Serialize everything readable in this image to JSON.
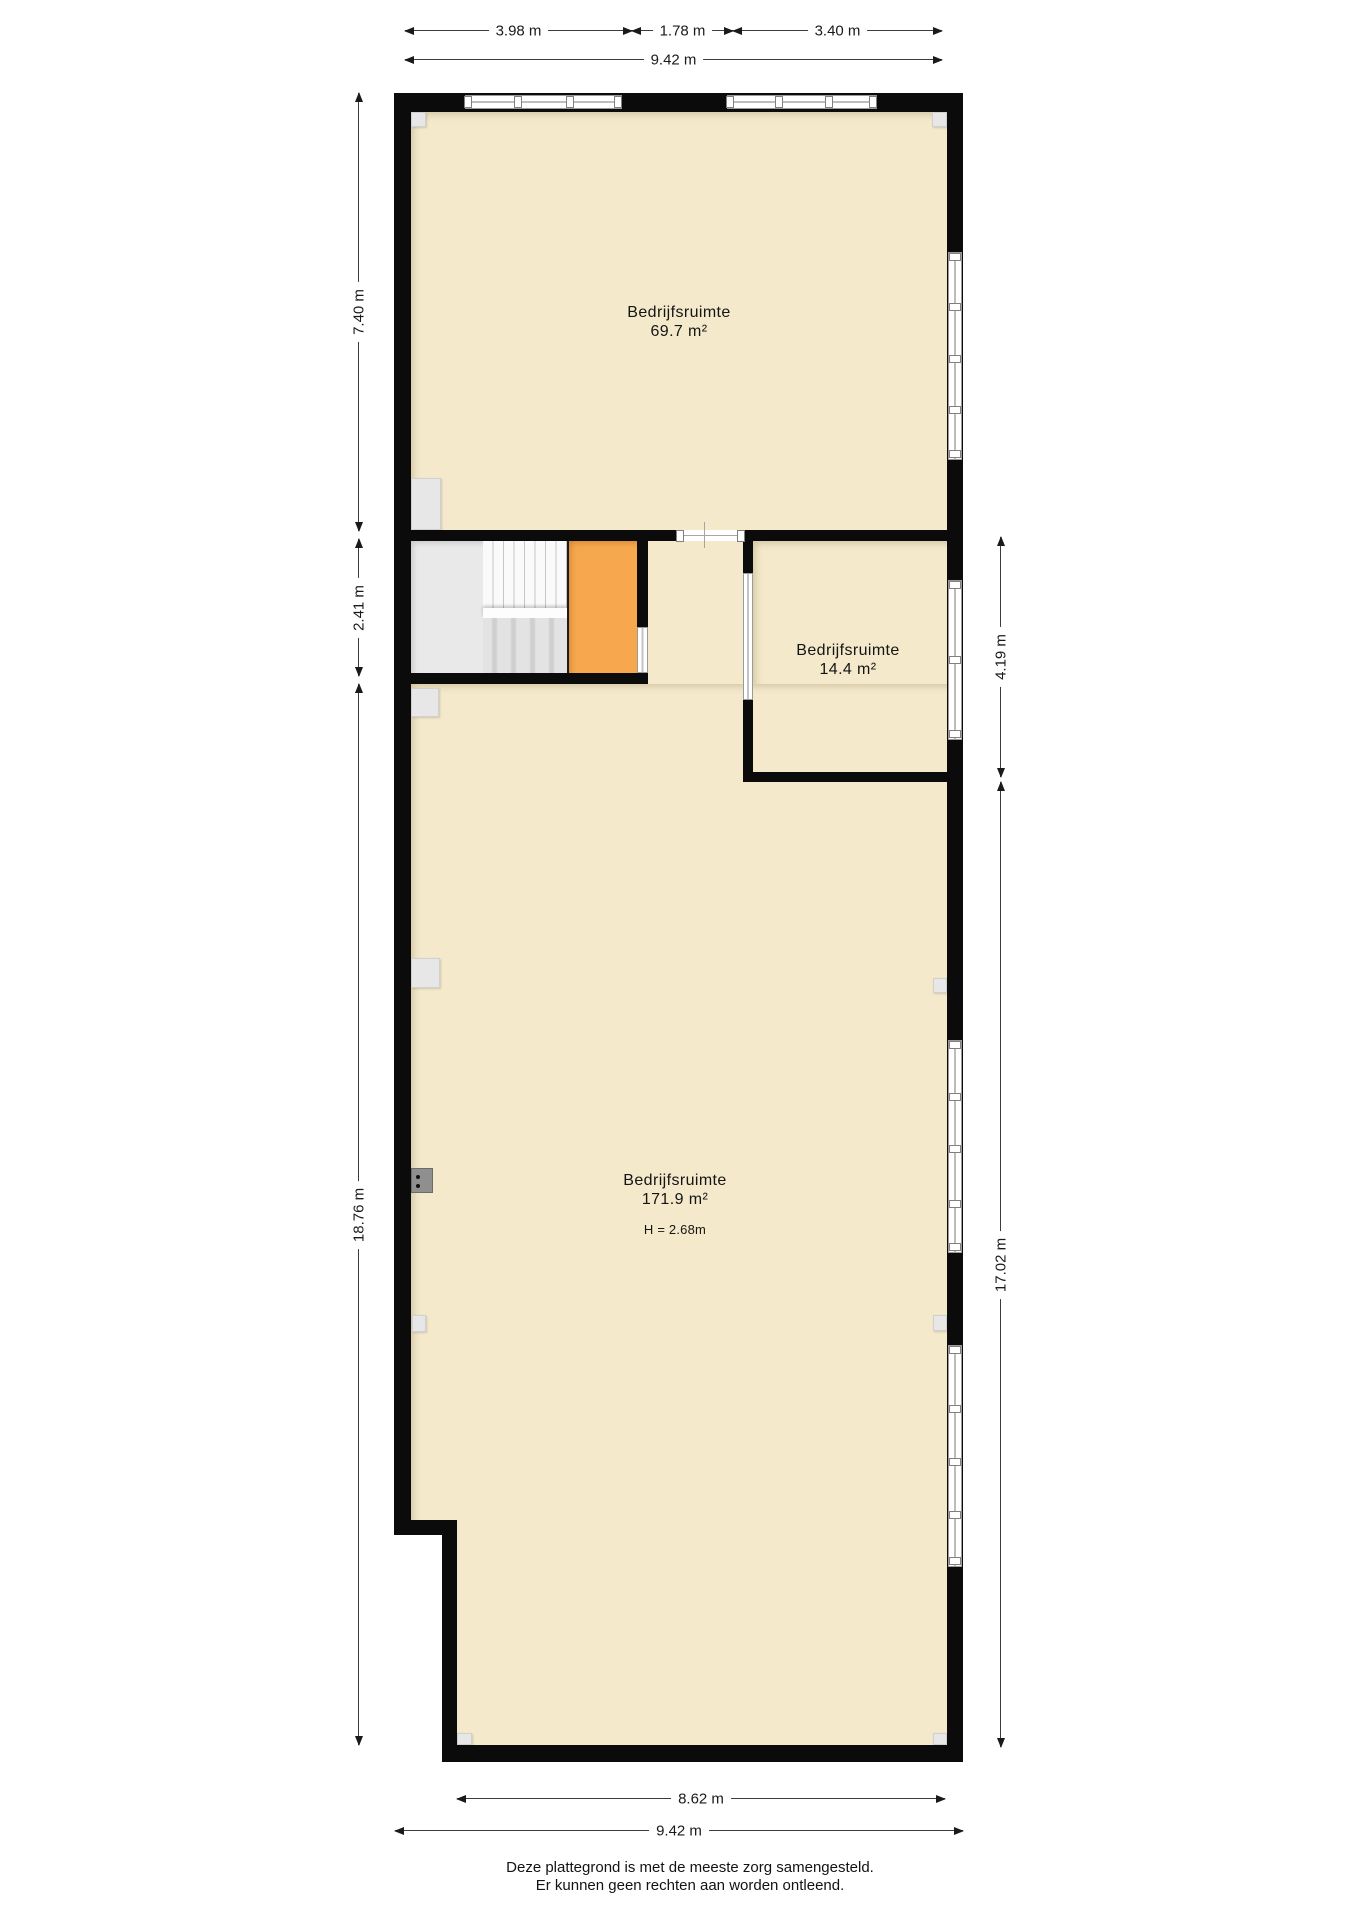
{
  "plan": {
    "rooms": {
      "room1": {
        "name": "Bedrijfsruimte",
        "area": "69.7 m²"
      },
      "room2": {
        "name": "Bedrijfsruimte",
        "area": "14.4 m²"
      },
      "room3": {
        "name": "Bedrijfsruimte",
        "area": "171.9 m²",
        "ceiling_height": "H = 2.68m"
      }
    },
    "dimensions": {
      "top_segments": [
        "3.98 m",
        "1.78 m",
        "3.40 m"
      ],
      "top_total": "9.42 m",
      "left": [
        "7.40 m",
        "2.41 m",
        "18.76 m"
      ],
      "right": [
        "4.19 m",
        "17.02 m"
      ],
      "bottom_inner": "8.62 m",
      "bottom_total": "9.42 m"
    },
    "colors": {
      "room_fill": "#f4e9cb",
      "lift_fill": "#f7a84f",
      "wall": "#0b0b0b",
      "hall_floor": "#e9e9e9"
    }
  },
  "footer": {
    "line1": "Deze plattegrond is met de meeste zorg samengesteld.",
    "line2": "Er kunnen geen rechten aan worden ontleend."
  }
}
